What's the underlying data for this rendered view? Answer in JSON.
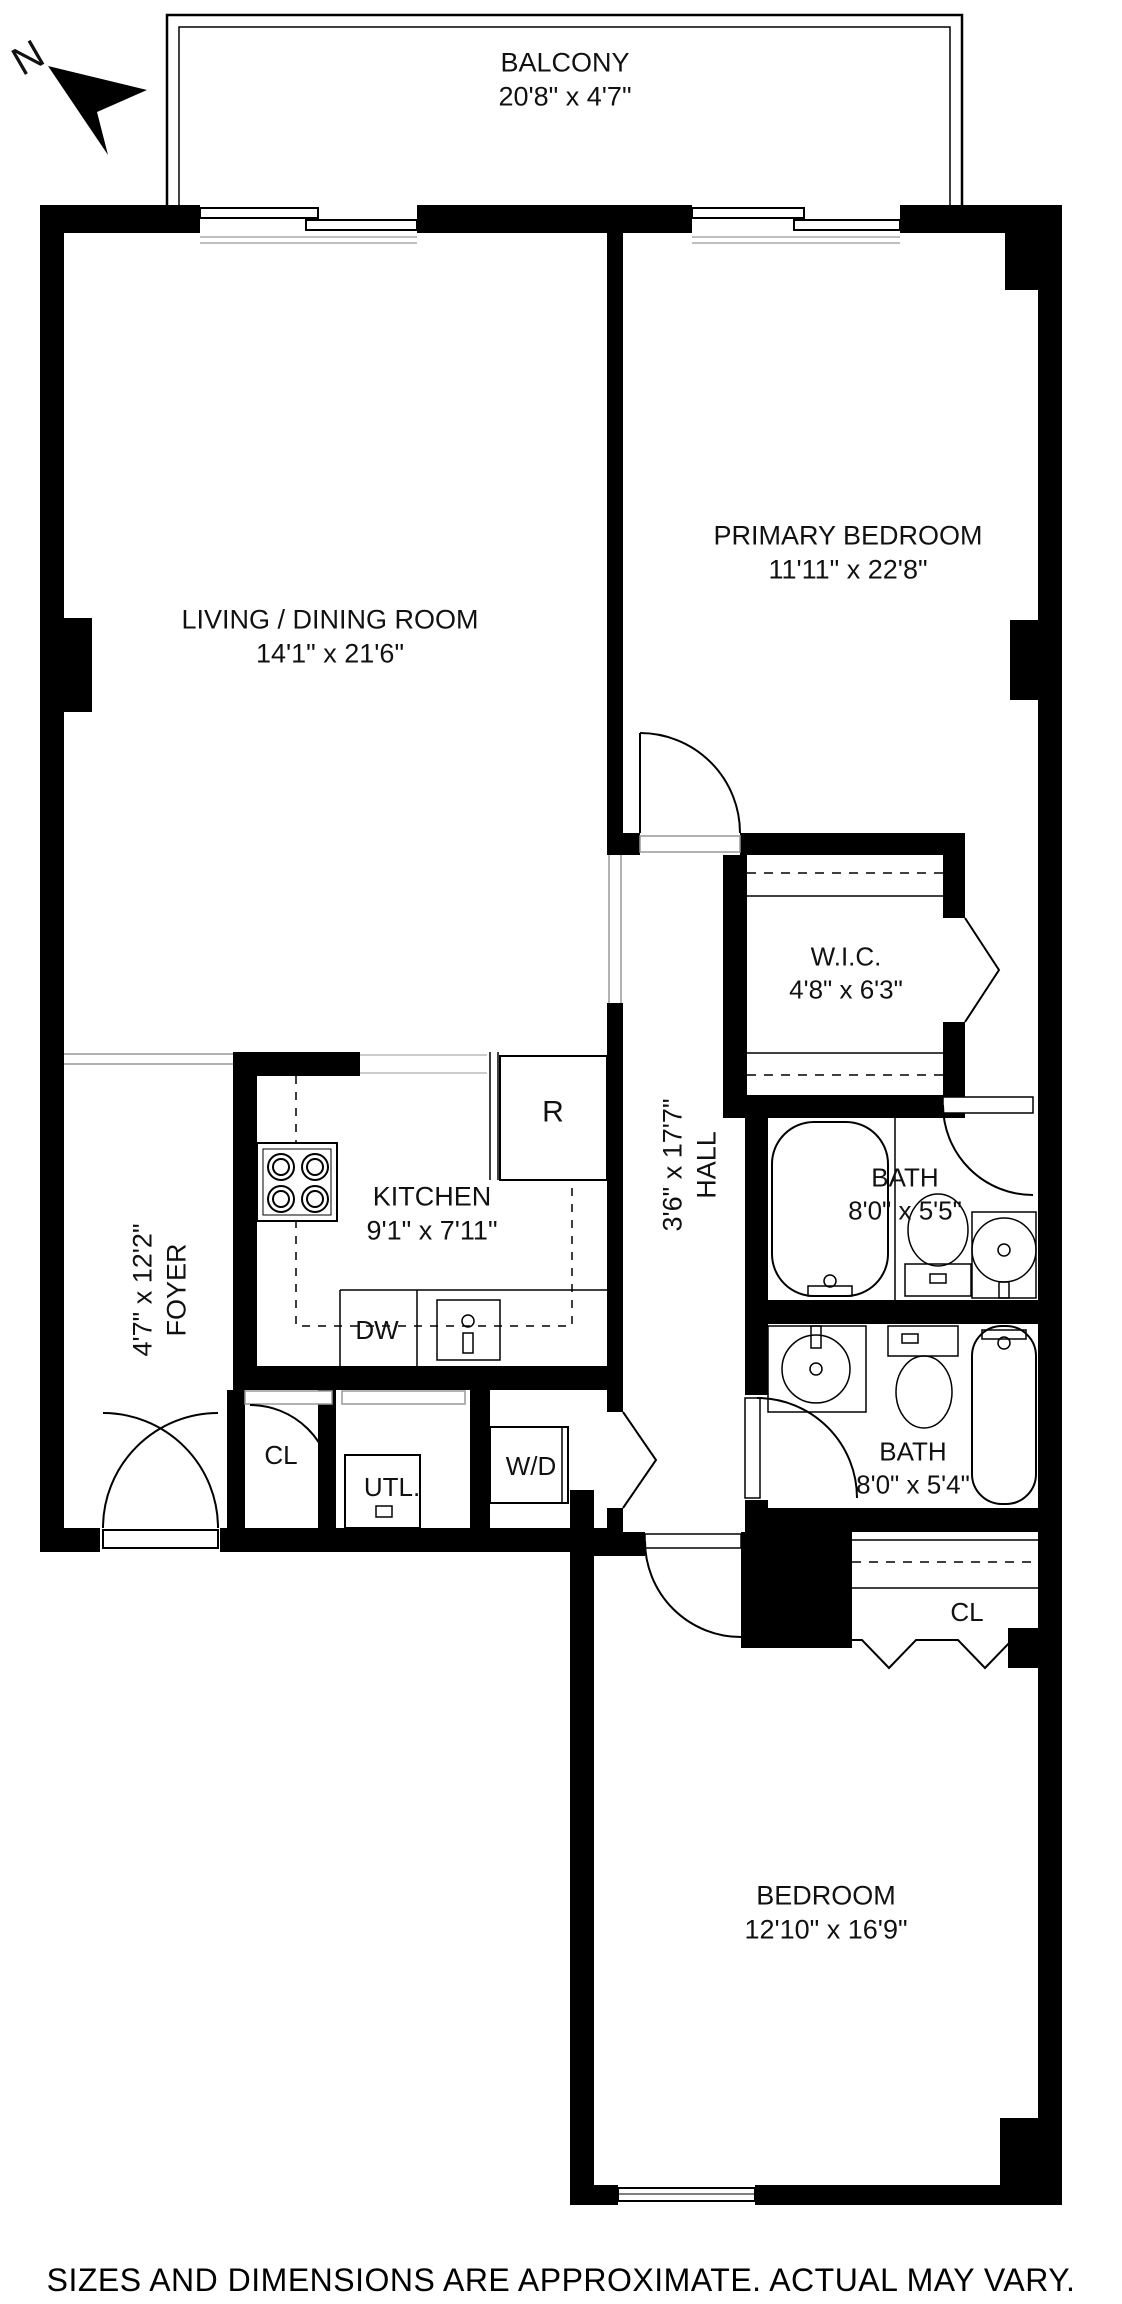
{
  "page": {
    "disclaimer": "SIZES AND DIMENSIONS ARE APPROXIMATE. ACTUAL MAY VARY.",
    "wall_color": "#000000",
    "background": "#ffffff"
  },
  "compass": {
    "label": "N"
  },
  "rooms": {
    "balcony": {
      "name": "BALCONY",
      "dims": "20'8\" x 4'7\""
    },
    "living": {
      "name": "LIVING / DINING ROOM",
      "dims": "14'1\" x 21'6\""
    },
    "primary": {
      "name": "PRIMARY BEDROOM",
      "dims": "11'11\" x 22'8\""
    },
    "wic": {
      "name": "W.I.C.",
      "dims": "4'8\" x 6'3\""
    },
    "kitchen": {
      "name": "KITCHEN",
      "dims": "9'1\" x 7'11\""
    },
    "hall": {
      "name": "HALL",
      "dims": "3'6\" x 17'7\""
    },
    "foyer": {
      "name": "FOYER",
      "dims": "4'7\" x 12'2\""
    },
    "bath1": {
      "name": "BATH",
      "dims": "8'0\" x 5'5\""
    },
    "bath2": {
      "name": "BATH",
      "dims": "8'0\" x 5'4\""
    },
    "bedroom": {
      "name": "BEDROOM",
      "dims": "12'10\" x 16'9\""
    }
  },
  "fixtures": {
    "refrigerator": "R",
    "dishwasher": "DW",
    "foyer_closet": "CL",
    "utility": "UTL.",
    "washer_dryer": "W/D",
    "bedroom_closet": "CL"
  }
}
